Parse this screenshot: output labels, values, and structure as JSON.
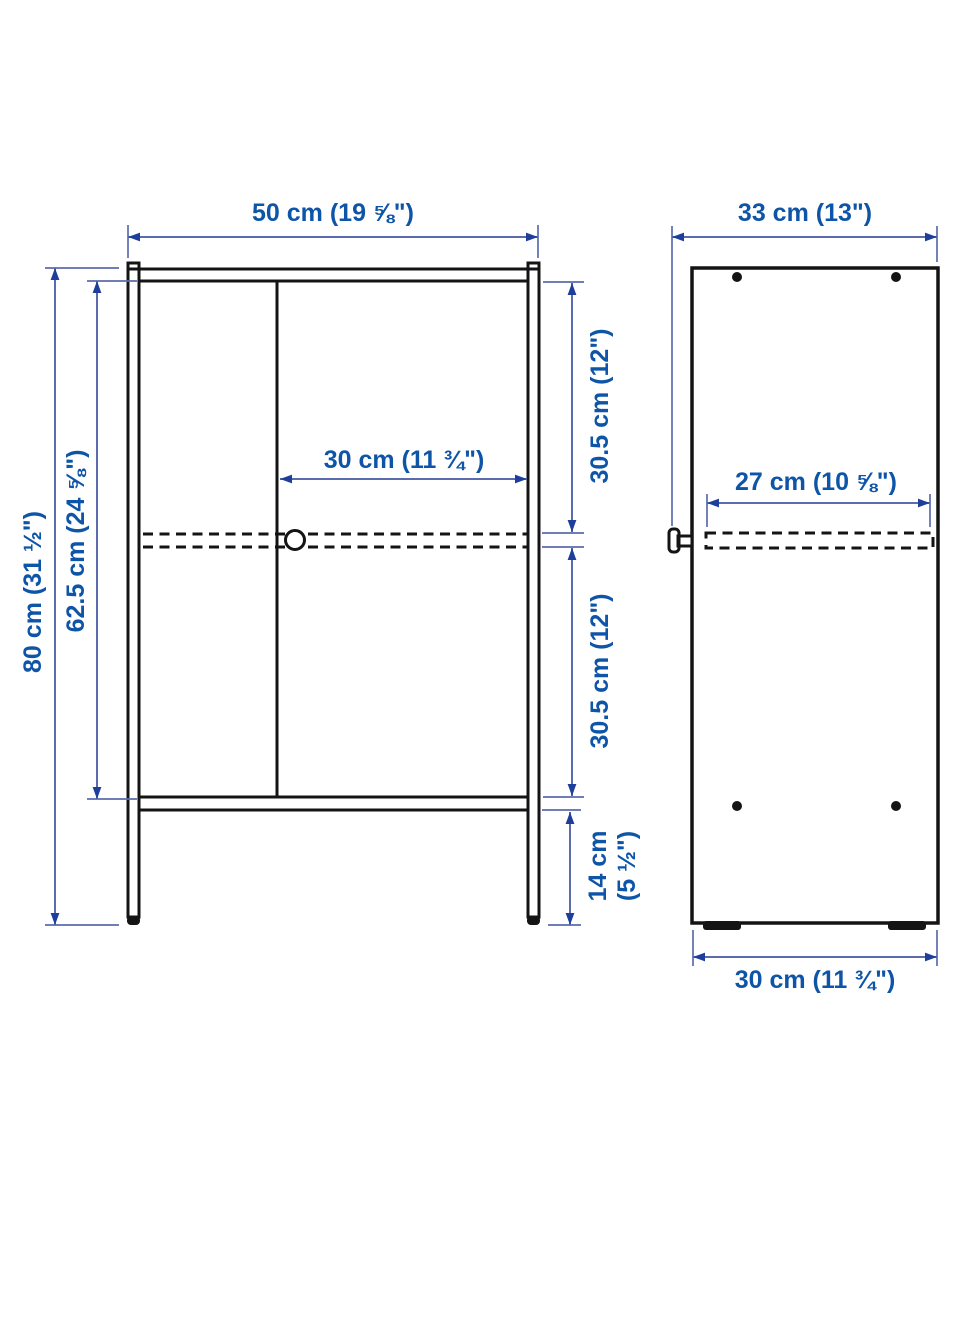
{
  "diagram": {
    "kind": "furniture-dimension-drawing",
    "views": [
      "front",
      "side"
    ]
  },
  "colors": {
    "background": "#ffffff",
    "outline": "#141414",
    "label_text": "#0e55a8",
    "dimension_line": "#5b6cae",
    "arrowhead": "#1d3f9b"
  },
  "front": {
    "width_label": "50 cm (19 ⅝\")",
    "height_label": "80 cm (31 ½\")",
    "body_height_label": "62.5 cm (24 ⅝\")",
    "door_width_label": "30 cm (11 ¾\")",
    "upper_compartment_label": "30.5 cm (12\")",
    "lower_compartment_label": "30.5 cm (12\")",
    "leg_clearance_line1": "14 cm",
    "leg_clearance_line2": "(5 ½\")"
  },
  "side": {
    "depth_label": "33 cm (13\")",
    "shelf_depth_label": "27 cm (10 ⅝\")",
    "base_depth_label": "30 cm (11 ¾\")"
  }
}
